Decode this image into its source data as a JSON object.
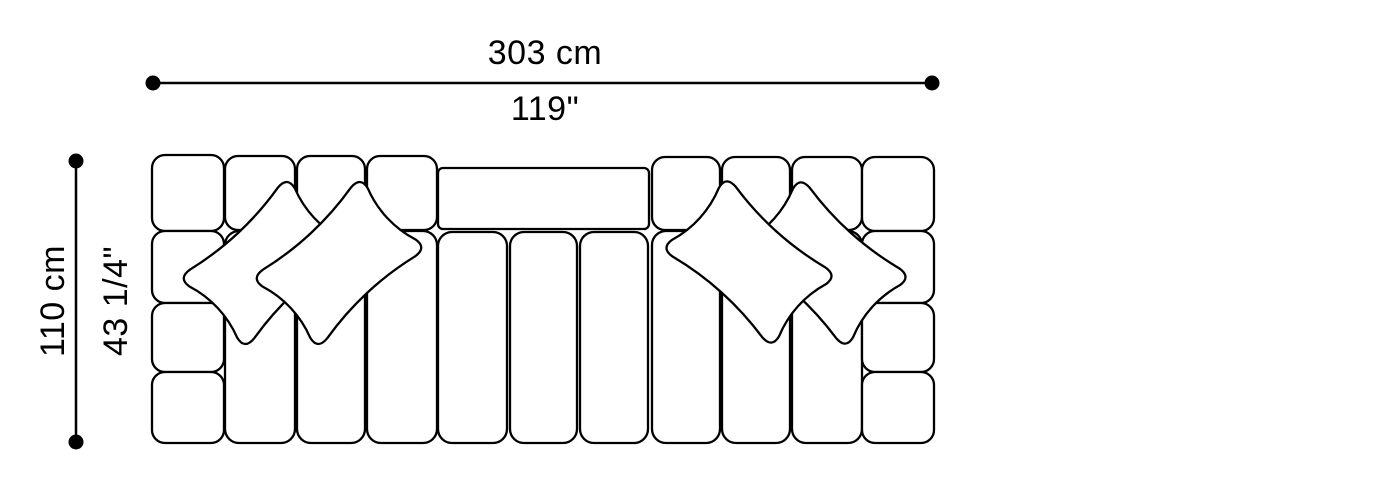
{
  "diagram": {
    "type": "furniture-technical-drawing",
    "view": "top-plan-view",
    "subject": "modular tufted sofa with throw pillows",
    "throw_pillow_count": 4,
    "sections": [
      "left-armrest-4-cushions",
      "left-seat-3-channels",
      "center-backrest-panel",
      "center-seat-3-channels",
      "right-seat-3-channels",
      "right-armrest-4-cushions"
    ]
  },
  "dimensions": {
    "width": {
      "metric": "303 cm",
      "imperial": "119\""
    },
    "depth": {
      "metric": "110 cm",
      "imperial": "43 1/4\""
    }
  },
  "colors": {
    "line": "#000000",
    "background": "#ffffff"
  }
}
